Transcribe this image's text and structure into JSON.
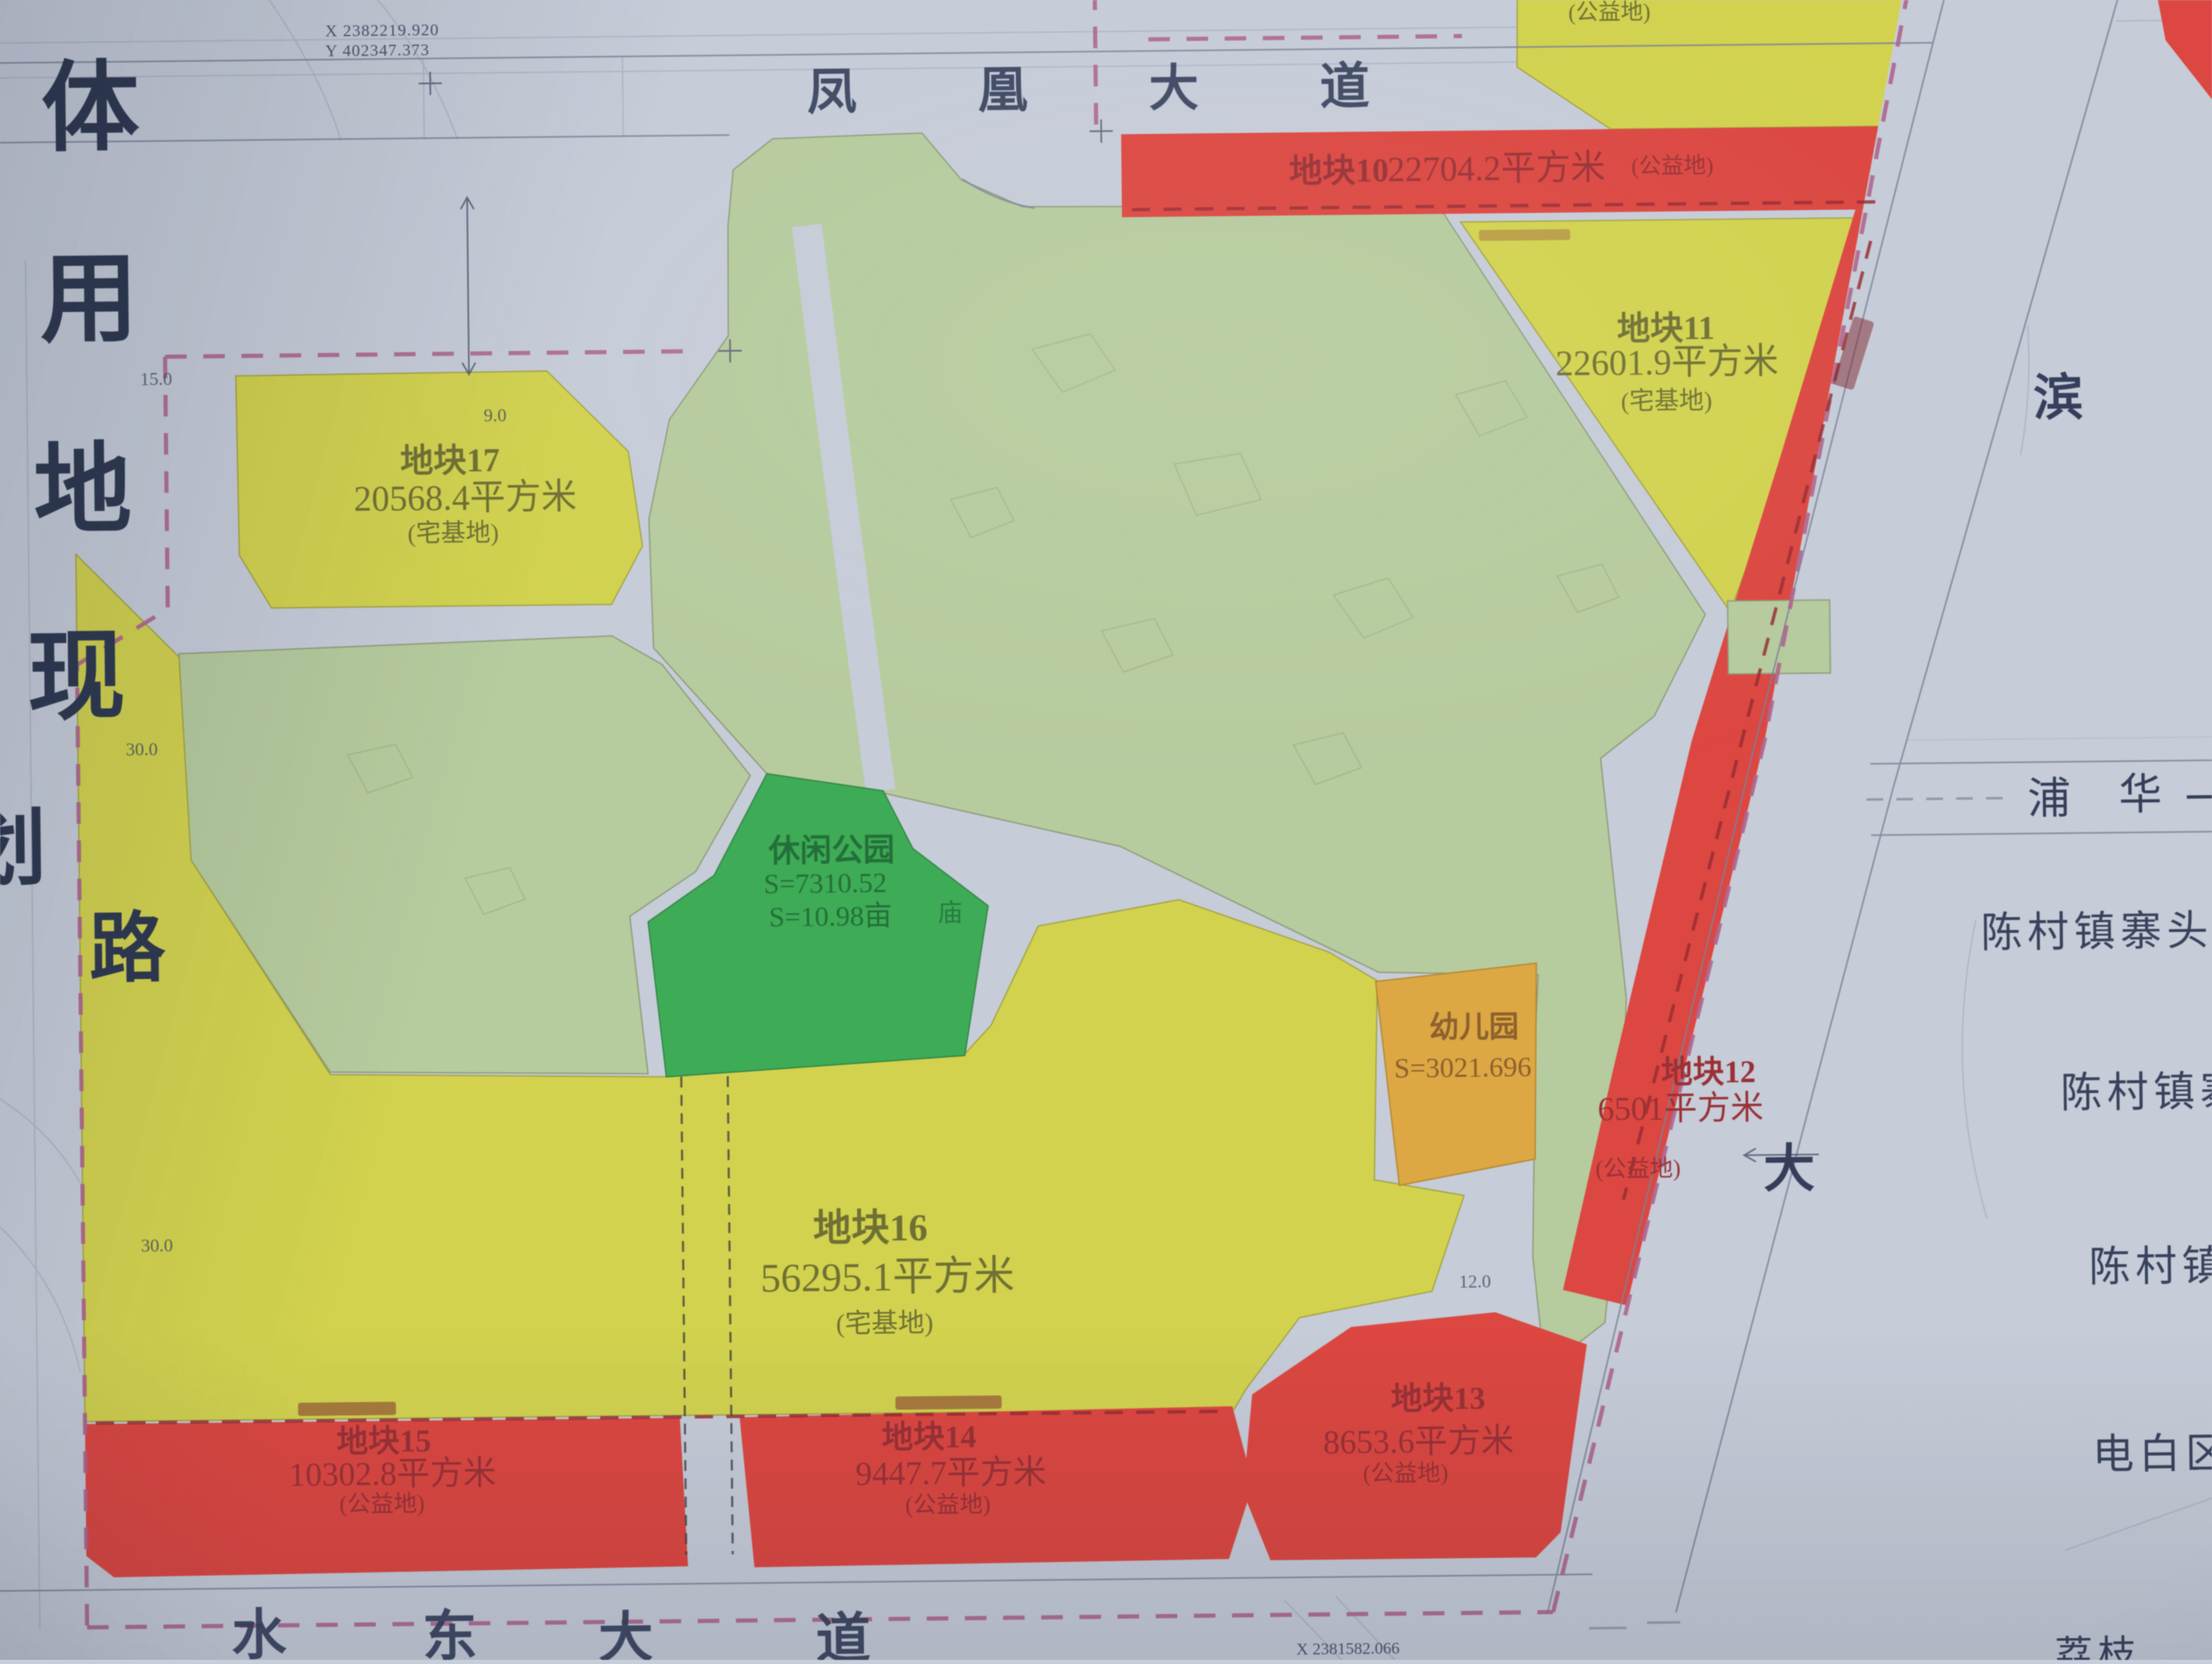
{
  "colors": {
    "background": "#c7ceda",
    "red": "#e2453f",
    "yellow": "#d4d44a",
    "sage_green": "#b7cd9d",
    "park_green": "#3aad53",
    "orange": "#e0a83e",
    "boundary_pink": "#b0648e",
    "navy_text": "#34405c",
    "red_text": "#9c2f34",
    "olive_text": "#6f7030",
    "park_text": "#1f6f36",
    "orange_text": "#8f5f2a"
  },
  "title_column": {
    "chars": [
      "体",
      "用",
      "地",
      "现",
      "划"
    ]
  },
  "road_labels": {
    "top": [
      "凤",
      "凰",
      "大",
      "道"
    ],
    "bottom": [
      "水",
      "东",
      "大",
      "道"
    ],
    "right_diagonal": [
      "滨",
      "大"
    ],
    "right_horizontal": [
      "浦",
      "华"
    ],
    "left_vertical": "路"
  },
  "survey_coords": {
    "top_x": "X 2382219.920",
    "top_y": "Y 402347.373",
    "bottom_x": "X 2381582.066"
  },
  "parcels": {
    "p10": {
      "name": "地块10",
      "area": "22704.2平方米",
      "type": "(公益地)"
    },
    "p11": {
      "name": "地块11",
      "area": "22601.9平方米",
      "type": "(宅基地)"
    },
    "p12": {
      "name": "地块12",
      "area": "6501平方米",
      "type": "(公益地)"
    },
    "p13": {
      "name": "地块13",
      "area": "8653.6平方米",
      "type": "(公益地)"
    },
    "p14": {
      "name": "地块14",
      "area": "9447.7平方米",
      "type": "(公益地)"
    },
    "p15": {
      "name": "地块15",
      "area": "10302.8平方米",
      "type": "(公益地)"
    },
    "p16": {
      "name": "地块16",
      "area": "56295.1平方米",
      "type": "(宅基地)"
    },
    "p17": {
      "name": "地块17",
      "area": "20568.4平方米",
      "type": "(宅基地)"
    },
    "top_right_note": "(公益地)"
  },
  "features": {
    "leisure_park": {
      "name": "休闲公园",
      "area_line1": "S=7310.52",
      "area_line2": "S=10.98亩"
    },
    "kindergarten": {
      "name": "幼儿园",
      "area": "S=3021.696"
    },
    "temple": "庙"
  },
  "place_labels": {
    "label1": "陈村镇寨头小",
    "label2": "陈村镇寨",
    "label3": "陈村镇",
    "label4": "电白区",
    "bottom_right_partial": "荔枝"
  },
  "dimension_labels": {
    "d1": "15.0",
    "d2": "30.0",
    "d3": "30.0",
    "d4": "9.0",
    "d5": "12.0"
  }
}
